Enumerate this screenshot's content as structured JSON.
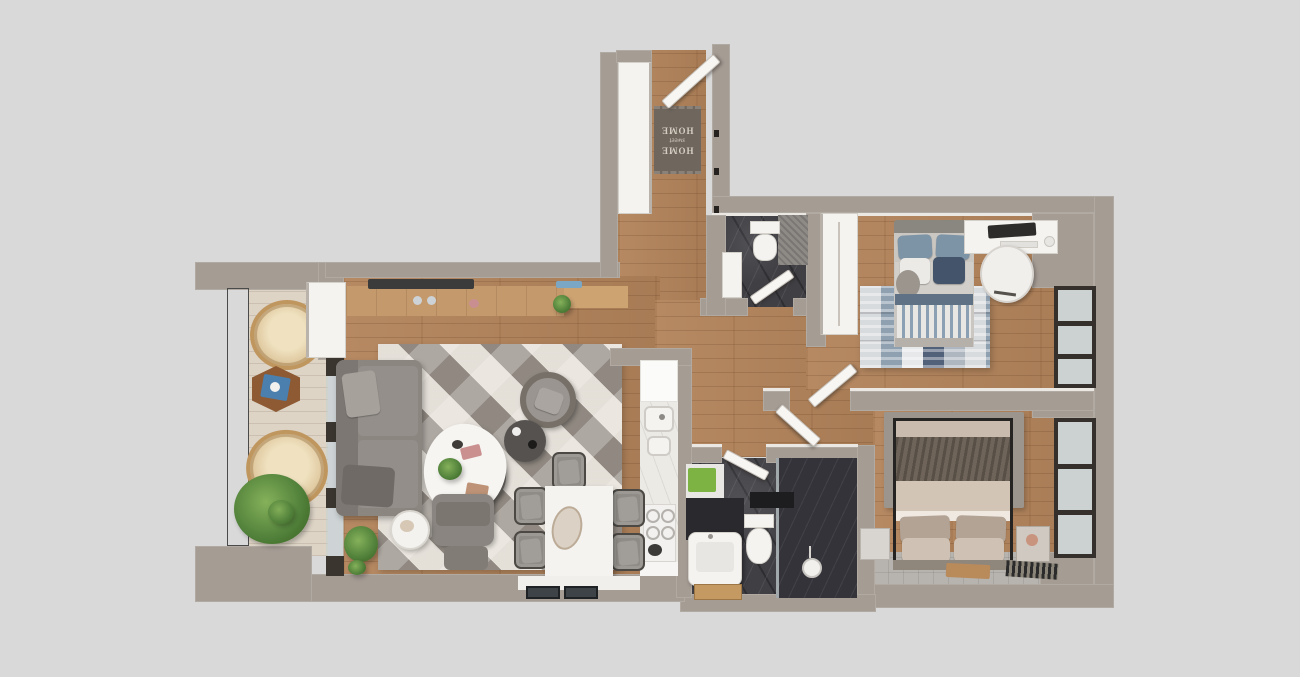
{
  "scene": {
    "kind": "top-down 3d apartment floor plan render",
    "background_color": "#d9d9d9"
  },
  "doormat": {
    "line_top": "HOME",
    "line_mid": "sweet",
    "line_bottom": "HOME"
  },
  "palette": {
    "background": "#d9d9d9",
    "wall": "#a59c94",
    "wall_trim": "#ebe8e3",
    "wood_floor": "#b2835a",
    "balcony_floor": "#ddd4c6",
    "dark_marble": "#403f44",
    "gray_tile": "#b7b3ae",
    "white_furniture": "#f4f3f0",
    "sofa_gray": "#8b8680",
    "navy_pillow": "#44546b",
    "blue_pillow": "#7d93a6",
    "towel_green": "#7cb342",
    "counter_wood": "#c49a6c",
    "rattan": "#dcc49a",
    "plant_green": "#50803a",
    "master_blanket": "#6e6459",
    "master_bedding": "#d3c5b6"
  },
  "rooms": [
    {
      "name": "entry-hall",
      "furniture": [
        "closet",
        "doormat",
        "entry-door",
        "wall-hooks"
      ]
    },
    {
      "name": "entry-bathroom",
      "furniture": [
        "toilet",
        "sink",
        "door"
      ]
    },
    {
      "name": "bedroom-1",
      "furniture": [
        "wardrobe",
        "single-bed",
        "patchwork-rug",
        "desk",
        "laptop",
        "chair",
        "window"
      ]
    },
    {
      "name": "hallway",
      "furniture": [
        "bedroom-1-door",
        "bedroom-2-door"
      ]
    },
    {
      "name": "bedroom-2",
      "furniture": [
        "double-bed",
        "rug",
        "nightstand-left",
        "nightstand-right",
        "runner-mat",
        "window"
      ]
    },
    {
      "name": "main-bathroom",
      "furniture": [
        "shower",
        "shower-head",
        "glass-panel",
        "toilet",
        "sink",
        "towel",
        "wood-tray"
      ]
    },
    {
      "name": "kitchen",
      "furniture": [
        "tall-cabinet",
        "wood-counter",
        "cooktop-hob",
        "island-sink",
        "island-cooktop"
      ]
    },
    {
      "name": "dining-area",
      "furniture": [
        "table",
        "decor-bowl",
        "chair-top",
        "chair-left-1",
        "chair-left-2",
        "chair-right-1",
        "chair-right-2"
      ]
    },
    {
      "name": "living-room",
      "furniture": [
        "sofa",
        "geometric-rug",
        "coffee-table",
        "ottoman",
        "armchair",
        "side-table",
        "pouf",
        "round-side-table",
        "plant"
      ]
    },
    {
      "name": "balcony",
      "furniture": [
        "railing",
        "rattan-chair-1",
        "hex-table",
        "rattan-chair-2",
        "agave-plant",
        "glass-sliding-door"
      ]
    }
  ]
}
